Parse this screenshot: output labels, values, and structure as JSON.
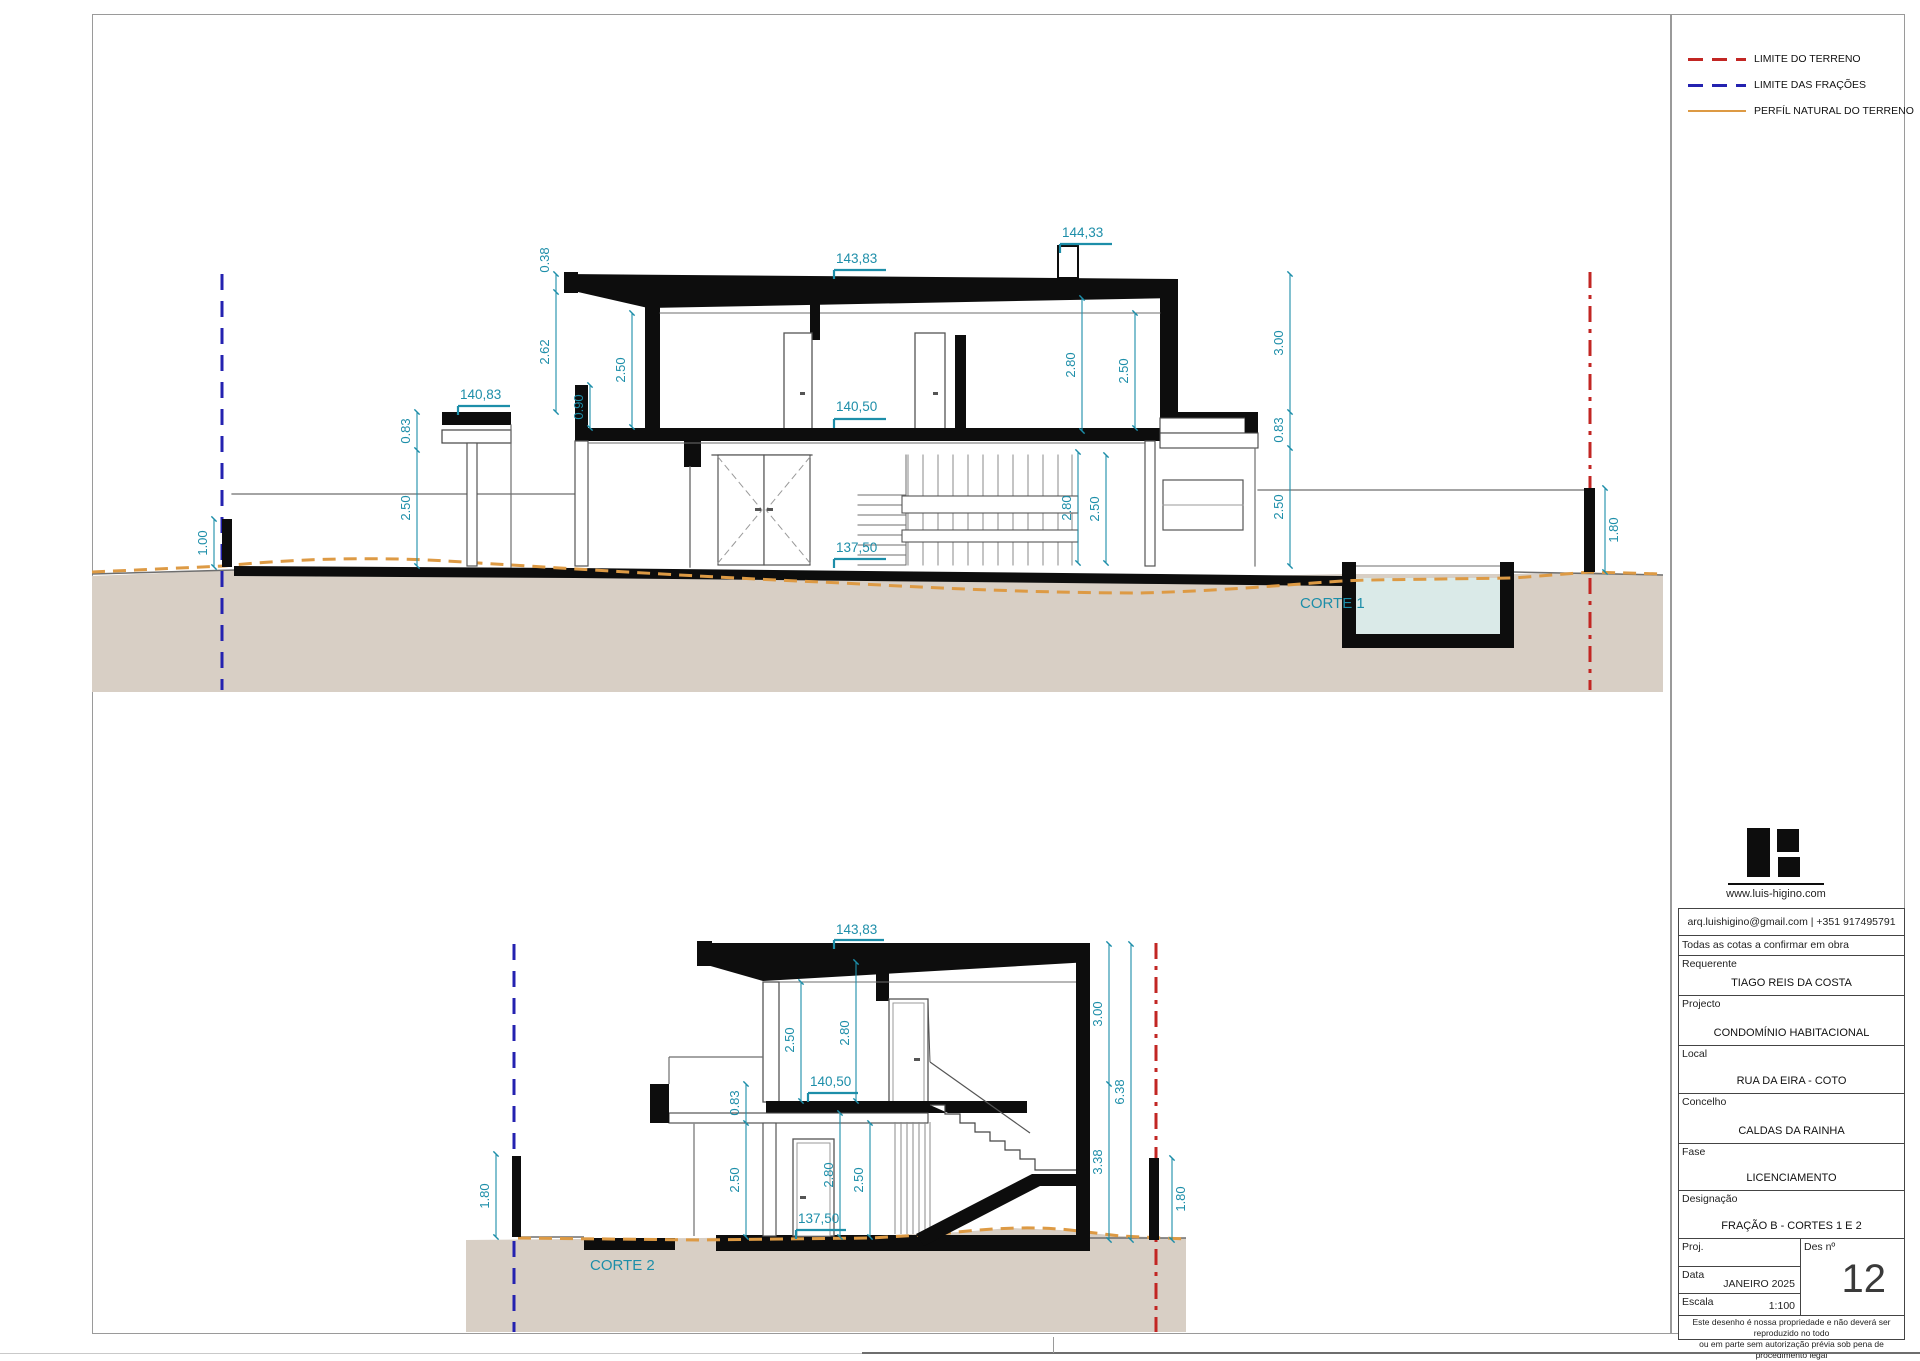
{
  "colors": {
    "dimension": "#1d8ea9",
    "terrain_limit": "#c22623",
    "fraction_limit": "#2422b0",
    "terrain_profile": "#dd9a44",
    "ground_fill": "#d8cfc5",
    "pool_water": "#daeae8",
    "wall_black": "#0d0d0d"
  },
  "legend": {
    "items": [
      {
        "label": "LIMITE DO TERRENO",
        "color": "#c22623",
        "pattern": "dashed"
      },
      {
        "label": "LIMITE DAS FRAÇÕES",
        "color": "#2422b0",
        "pattern": "dashed"
      },
      {
        "label": "PERFÍL NATURAL DO TERRENO",
        "color": "#dd9a44",
        "pattern": "solid"
      }
    ]
  },
  "corte1": {
    "label": "CORTE 1",
    "levels": {
      "roof": "143,83",
      "chimney": "144,33",
      "pergola": "140,83",
      "floor1": "140,50",
      "floor0": "137,50"
    },
    "dims": {
      "eave": "0.38",
      "left_total": "2.62",
      "left_interior": "2.50",
      "parapet": "0.90",
      "pergola_thk": "0.83",
      "pergola_h": "2.50",
      "low_wall": "1.00",
      "int_h1": "2.80",
      "int_h2": "2.50",
      "gf_h1": "2.80",
      "gf_h2": "2.50",
      "right_total": "3.00",
      "terrace_thk": "0.83",
      "gf_right": "2.50",
      "bound_wall": "1.80"
    }
  },
  "corte2": {
    "label": "CORTE 2",
    "levels": {
      "roof": "143,83",
      "floor1": "140,50",
      "floor0": "137,50"
    },
    "dims": {
      "up_int": "2.50",
      "up_h": "2.80",
      "slab_thk": "0.83",
      "gf_left": "2.50",
      "gf_h": "2.80",
      "gf_int": "2.50",
      "upper_right": "3.00",
      "total_right": "6.38",
      "lower_right": "3.38",
      "bound_left": "1.80",
      "bound_right": "1.80"
    }
  },
  "titleblock": {
    "website": "www.luis-higino.com",
    "contact": "arq.luishigino@gmail.com  | +351 917495791",
    "note": "Todas as cotas a confirmar em obra",
    "fields": [
      {
        "label": "Requerente",
        "value": "TIAGO REIS DA COSTA"
      },
      {
        "label": "Projecto",
        "value": "CONDOMÍNIO HABITACIONAL"
      },
      {
        "label": "Local",
        "value": "RUA DA EIRA  - COTO"
      },
      {
        "label": "Concelho",
        "value": "CALDAS DA RAINHA"
      },
      {
        "label": "Fase",
        "value": "LICENCIAMENTO"
      },
      {
        "label": "Designação",
        "value": "FRAÇÃO B - CORTES 1 E 2"
      }
    ],
    "proj_label": "Proj.",
    "data_label": "Data",
    "data_value": "JANEIRO 2025",
    "escala_label": "Escala",
    "escala_value": "1:100",
    "des_label": "Des nº",
    "des_value": "12",
    "footer_line1": "Este desenho é nossa propriedade e não deverá ser reproduzido no todo",
    "footer_line2": "ou em parte sem autorização prévia sob pena de procedimento legal"
  }
}
